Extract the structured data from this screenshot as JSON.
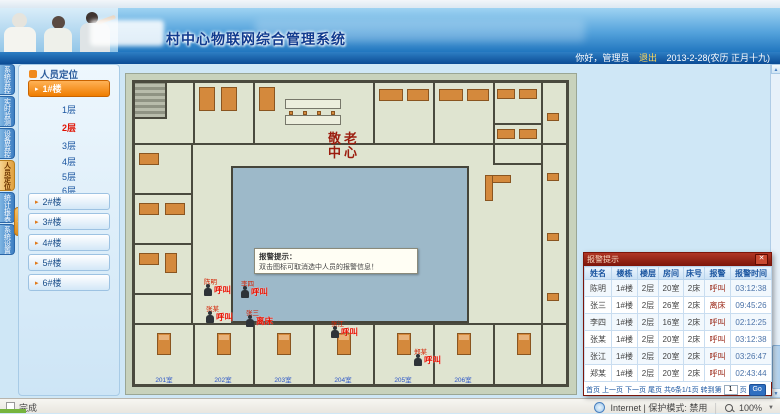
{
  "header": {
    "title": "村中心物联网综合管理系统",
    "greeting": "你好，管理员",
    "logout": "退出",
    "date": "2013-2-28(农历 正月十九)"
  },
  "nav_tabs": [
    {
      "label": "系统监控",
      "active": false
    },
    {
      "label": "实时监测",
      "active": false
    },
    {
      "label": "设备监控",
      "active": false
    },
    {
      "label": "人员定位",
      "active": true
    },
    {
      "label": "统计报表",
      "active": false
    },
    {
      "label": "系统设置",
      "active": false
    }
  ],
  "sidebar": {
    "panel_title": "人员定位",
    "building_active": "1#楼",
    "floors": [
      {
        "label": "1层",
        "active": false
      },
      {
        "label": "2层",
        "active": true
      },
      {
        "label": "3层",
        "active": false
      },
      {
        "label": "4层",
        "active": false
      },
      {
        "label": "5层",
        "active": false
      },
      {
        "label": "6层",
        "active": false
      }
    ],
    "buildings": [
      {
        "label": "2#楼"
      },
      {
        "label": "3#楼"
      },
      {
        "label": "4#楼"
      },
      {
        "label": "5#楼"
      },
      {
        "label": "6#楼"
      }
    ]
  },
  "floorplan": {
    "caption_line1": "敬老",
    "caption_line2": "中心",
    "tooltip_line1": "报警提示：",
    "tooltip_line2": "双击图标可取消选中人员的报警信息！",
    "markers": [
      {
        "person": "陈明",
        "type": "呼叫"
      },
      {
        "person": "李四",
        "type": "呼叫"
      },
      {
        "person": "张某",
        "type": "呼叫"
      },
      {
        "person": "张三",
        "type": "离床"
      },
      {
        "person": "张江",
        "type": "呼叫"
      },
      {
        "person": "郑某",
        "type": "呼叫"
      }
    ],
    "room_labels": [
      "201室",
      "202室",
      "203室",
      "204室",
      "205室",
      "206室"
    ]
  },
  "alarm_popup": {
    "title": "报警提示",
    "close": "✕",
    "columns": [
      "姓名",
      "楼栋",
      "楼层",
      "房间",
      "床号",
      "报警",
      "报警时间"
    ],
    "rows": [
      [
        "陈明",
        "1#楼",
        "2层",
        "20室",
        "2床",
        "呼叫",
        "03:12:38"
      ],
      [
        "张三",
        "1#楼",
        "2层",
        "26室",
        "2床",
        "离床",
        "09:45:26"
      ],
      [
        "李四",
        "1#楼",
        "2层",
        "16室",
        "2床",
        "呼叫",
        "02:12:25"
      ],
      [
        "张某",
        "1#楼",
        "2层",
        "20室",
        "2床",
        "呼叫",
        "03:12:38"
      ],
      [
        "张江",
        "1#楼",
        "2层",
        "20室",
        "2床",
        "呼叫",
        "03:26:47"
      ],
      [
        "郑某",
        "1#楼",
        "2层",
        "20室",
        "2床",
        "呼叫",
        "02:43:44"
      ]
    ],
    "pagination": {
      "first": "首页",
      "prev": "上一页",
      "next": "下一页",
      "last": "尾页",
      "summary": "共6条1/1页",
      "goto": "转到第",
      "page": "1",
      "unit": "页",
      "go": "Go"
    }
  },
  "status_bar": {
    "left": "完成",
    "zone": "Internet | 保护模式: 禁用",
    "zoom": "100%",
    "caret": "▼"
  }
}
